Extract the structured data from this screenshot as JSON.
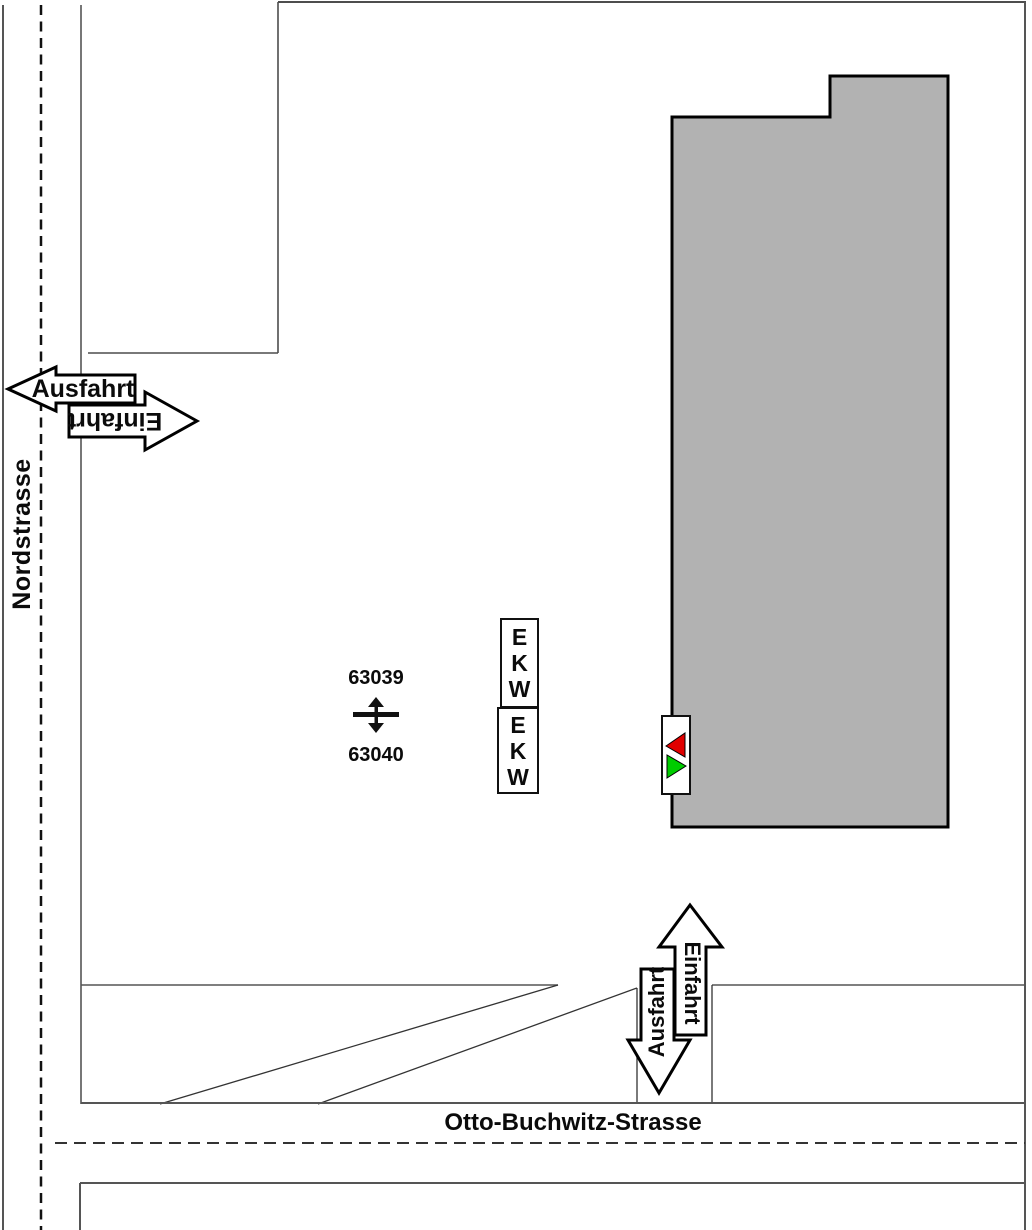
{
  "map": {
    "title_context": "site access plan",
    "streets": {
      "west_street_label": "Nordstrasse",
      "south_street_label": "Otto-Buchwitz-Strasse"
    },
    "upper_access": {
      "exit_label": "Ausfahrt",
      "entry_label": "Einfahrt"
    },
    "lower_access": {
      "exit_label": "Ausfahrt",
      "entry_label": "Einfahrt"
    },
    "pumps": {
      "top_id": "63039",
      "bottom_id": "63040"
    },
    "ekw_letters": [
      "E",
      "K",
      "W"
    ],
    "colors": {
      "building_fill": "#b2b2b2",
      "signal_red": "#e10000",
      "signal_green": "#00cc00",
      "line_gray": "#555555",
      "symbol_black": "#111111"
    }
  }
}
